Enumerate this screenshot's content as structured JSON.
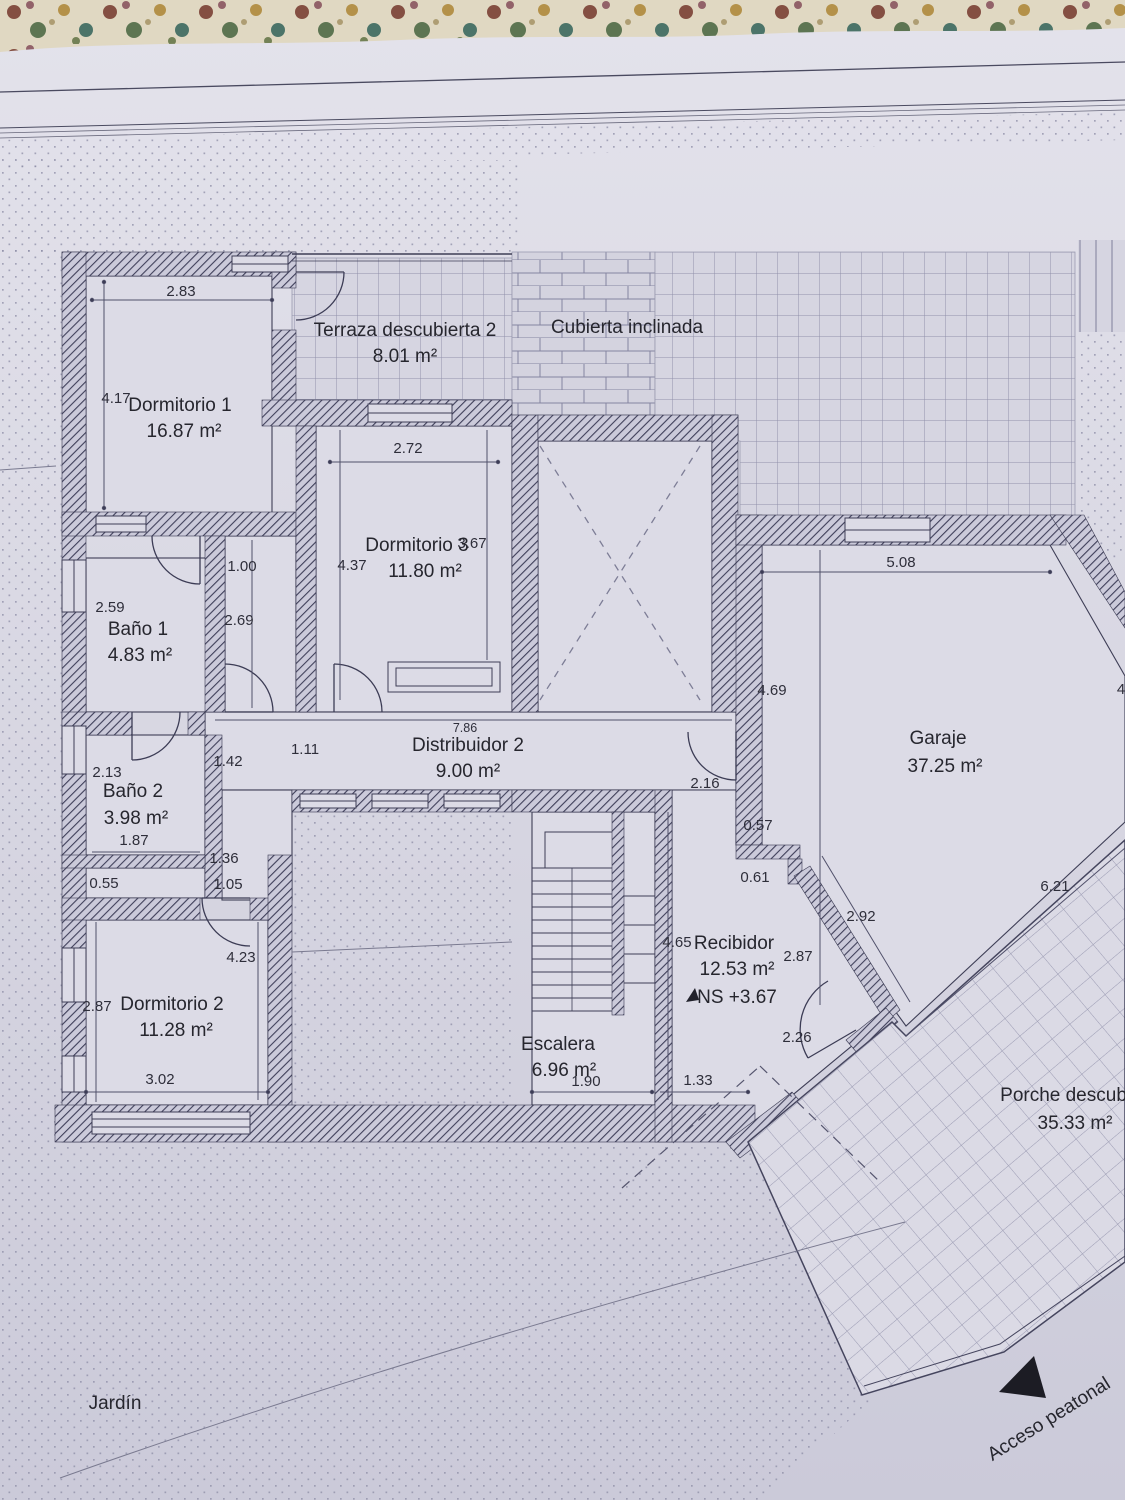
{
  "rooms": {
    "dormitorio1": {
      "name": "Dormitorio 1",
      "area": "16.87 m²"
    },
    "terraza2": {
      "name": "Terraza descubierta 2",
      "area": "8.01 m²"
    },
    "cubierta": {
      "name": "Cubierta inclinada"
    },
    "dormitorio3": {
      "name": "Dormitorio 3",
      "area": "11.80 m²"
    },
    "bano1": {
      "name": "Baño 1",
      "area": "4.83 m²"
    },
    "distribuidor2": {
      "name": "Distribuidor 2",
      "area": "9.00 m²"
    },
    "bano2": {
      "name": "Baño 2",
      "area": "3.98 m²"
    },
    "dormitorio2": {
      "name": "Dormitorio 2",
      "area": "11.28 m²"
    },
    "escalera": {
      "name": "Escalera",
      "area": "6.96 m²"
    },
    "recibidor": {
      "name": "Recibidor",
      "area": "12.53 m²",
      "level": "NS +3.67"
    },
    "garaje": {
      "name": "Garaje",
      "area": "37.25 m²"
    },
    "porche": {
      "name": "Porche descubierto",
      "area": "35.33 m²"
    }
  },
  "labels": {
    "jardin": "Jardín",
    "acceso": "Acceso peatonal"
  },
  "dims": {
    "d283": "2.83",
    "d417": "4.17",
    "d272": "2.72",
    "d437": "4.37",
    "d367": "3.67",
    "d100": "1.00",
    "d259": "2.59",
    "d269": "2.69",
    "d213": "2.13",
    "d142": "1.42",
    "d111": "1.11",
    "d786": "7.86",
    "d187": "1.87",
    "d055": "0.55",
    "d136": "1.36",
    "d105": "1.05",
    "d423": "4.23",
    "d287a": "2.87",
    "d302": "3.02",
    "d190": "1.90",
    "d133": "1.33",
    "d465": "4.65",
    "d216": "2.16",
    "d057": "0.57",
    "d061": "0.61",
    "d292": "2.92",
    "d287b": "2.87",
    "d226": "2.26",
    "d508": "5.08",
    "d469": "4.69",
    "d621": "6.21",
    "d4": "4"
  }
}
